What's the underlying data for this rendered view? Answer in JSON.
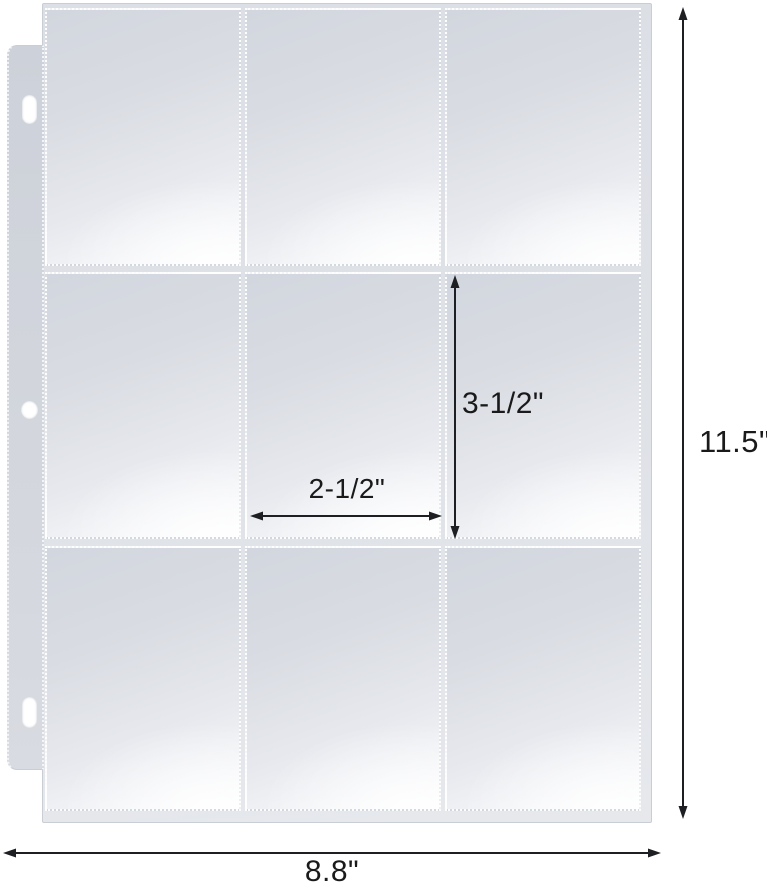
{
  "diagram": {
    "page": {
      "width_label": "8.8\"",
      "height_label": "11.5\""
    },
    "pocket": {
      "width_label": "2-1/2\"",
      "height_label": "3-1/2\""
    },
    "grid": {
      "rows": 3,
      "columns": 3,
      "pocket_count": 9,
      "binder_holes": 3
    }
  },
  "colors": {
    "background": "#ffffff",
    "sheet": "#dfe2e7",
    "sheet_edge": "#c9cdd4",
    "binder_strip": "#d0d4db",
    "pocket_top": "#d2d6de",
    "pocket_bottom": "#fcfdfd",
    "seam_dots": "#ffffff",
    "arrow": "#1d1f23",
    "label_text": "#1a1a1a"
  }
}
